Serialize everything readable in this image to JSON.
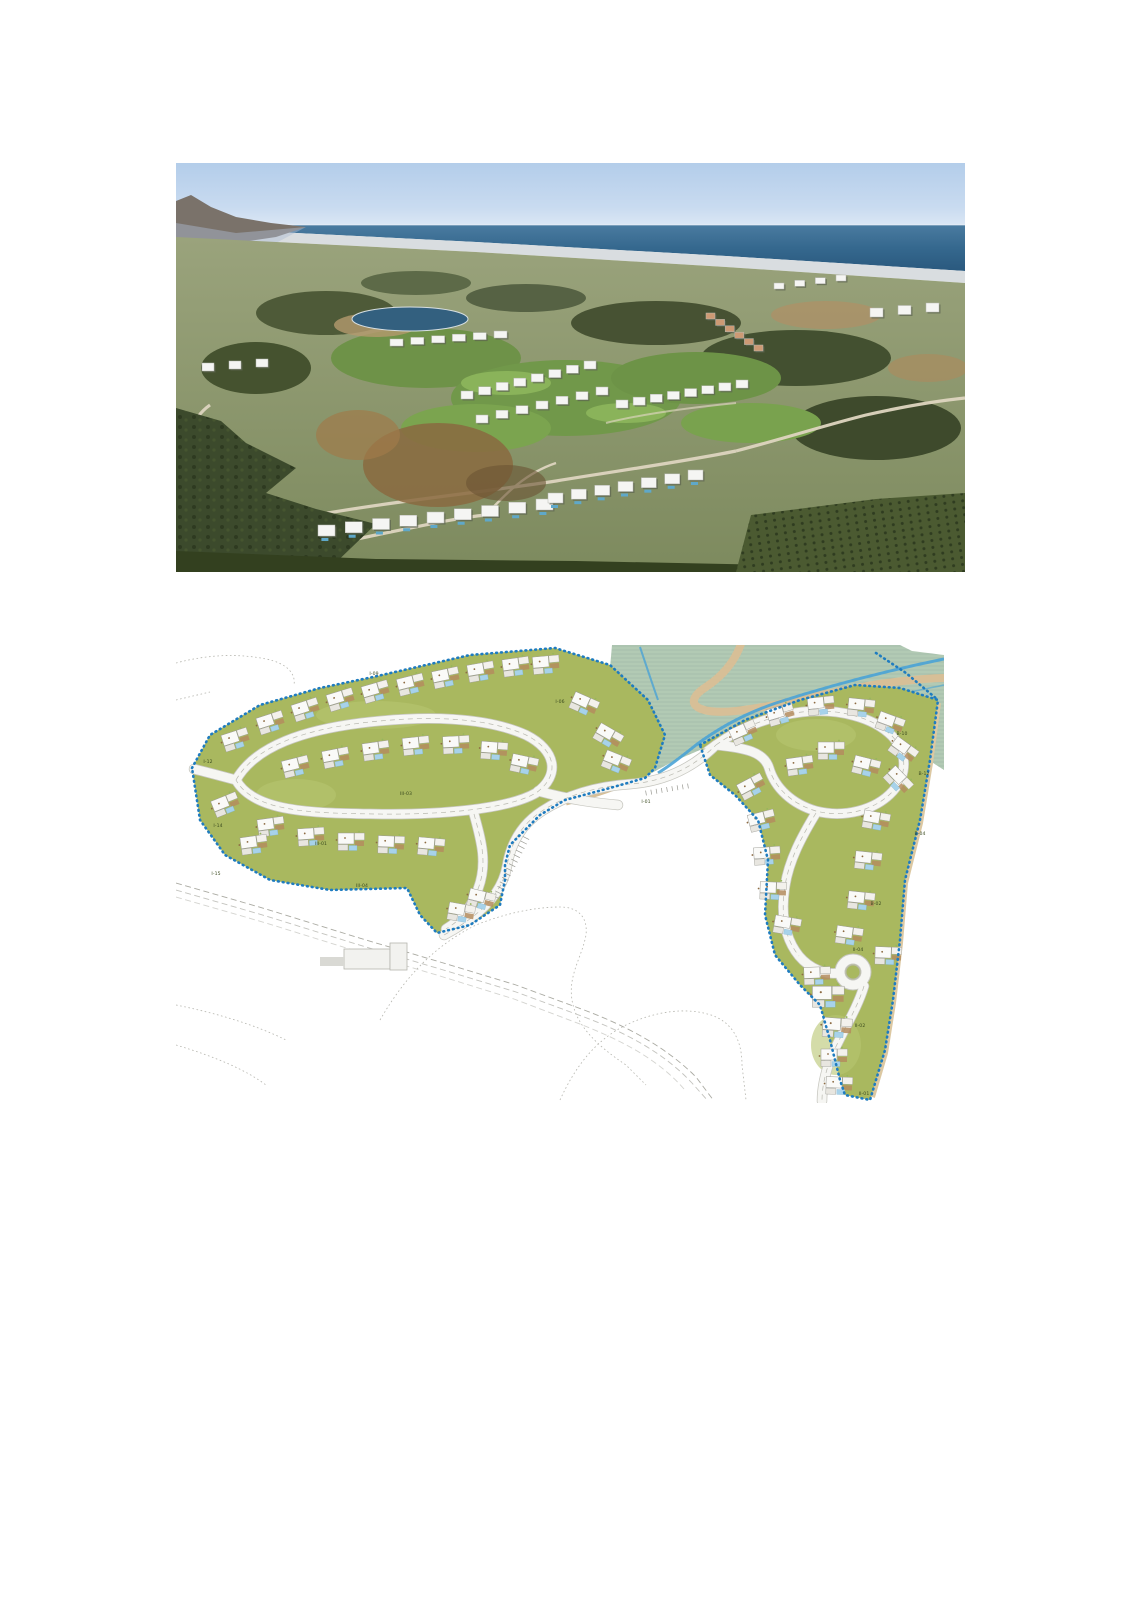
{
  "page": {
    "width": 1131,
    "height": 1600,
    "background": "#ffffff",
    "kind": "brochure-page-two-images"
  },
  "aerial_photo": {
    "name": "aerial-photo",
    "description": "Aerial photograph of a hillside resort: white modern villas along winding roads, golf course fairways with a small lake and hotel row, dark scrubland and orchards in the foreground, a coastal town strip and the Mediterranean sea on the horizon, mountain at left",
    "x": 176,
    "y": 163,
    "width": 789,
    "height": 409,
    "colors": {
      "sky": "#b5cfec",
      "sea": "#2e6089",
      "coast_city": "#d9dde0",
      "hills": "#97a076",
      "golf": "#7ba04f",
      "lake": "#33607f",
      "villas": "#f5f5f3",
      "foreground": "#35421f",
      "dirt": "#a9885c",
      "roads": "#ded5c0"
    }
  },
  "site_plan": {
    "name": "master-plan-map",
    "description": "Master plan drawing: two olive-green development areas bounded by a blue dotted line, internal loop roads with building footprints and pools, roundabout in the east sector, stream corridor with beige footpaths at top, faint dashed existing roads and contour lines around",
    "x": 176,
    "y": 645,
    "width": 768,
    "height": 458,
    "colors": {
      "plot_green": "#a9b85f",
      "road_fill": "#f6f6f3",
      "road_edge": "#c6c6bf",
      "boundary_dots": "#1f7cc0",
      "corridor": "#b8cdb6",
      "stream": "#4aa3d6",
      "path_beige": "#d7bf97",
      "building_white": "#fafaf8",
      "building_brown": "#b48c5e",
      "pool_blue": "#a7d2ea",
      "existing_lines": "#b0b0a9",
      "label_text": "#3a4a1f"
    },
    "plot_labels": [
      {
        "text": "I-09",
        "x": 198,
        "y": 30
      },
      {
        "text": "I-06",
        "x": 384,
        "y": 58
      },
      {
        "text": "I-01",
        "x": 470,
        "y": 158
      },
      {
        "text": "I-12",
        "x": 32,
        "y": 118
      },
      {
        "text": "I-14",
        "x": 42,
        "y": 182
      },
      {
        "text": "I-15",
        "x": 40,
        "y": 230
      },
      {
        "text": "III-03",
        "x": 230,
        "y": 150
      },
      {
        "text": "III-01",
        "x": 145,
        "y": 200
      },
      {
        "text": "III-04",
        "x": 186,
        "y": 242
      },
      {
        "text": "B-10",
        "x": 726,
        "y": 90
      },
      {
        "text": "B-12",
        "x": 748,
        "y": 130
      },
      {
        "text": "B-04",
        "x": 744,
        "y": 190
      },
      {
        "text": "B-02",
        "x": 700,
        "y": 260
      },
      {
        "text": "II-04",
        "x": 682,
        "y": 306
      },
      {
        "text": "II-02",
        "x": 684,
        "y": 382
      },
      {
        "text": "II-01",
        "x": 688,
        "y": 450
      }
    ],
    "building_clusters": [
      [
        60,
        95,
        -18
      ],
      [
        95,
        78,
        -18
      ],
      [
        130,
        65,
        -18
      ],
      [
        165,
        55,
        -17
      ],
      [
        200,
        47,
        -16
      ],
      [
        235,
        40,
        -14
      ],
      [
        270,
        33,
        -12
      ],
      [
        305,
        27,
        -10
      ],
      [
        340,
        22,
        -8
      ],
      [
        370,
        20,
        -5
      ],
      [
        120,
        122,
        -14
      ],
      [
        160,
        113,
        -11
      ],
      [
        200,
        106,
        -8
      ],
      [
        240,
        101,
        -6
      ],
      [
        280,
        100,
        -3
      ],
      [
        318,
        106,
        4
      ],
      [
        348,
        120,
        12
      ],
      [
        95,
        182,
        -8
      ],
      [
        135,
        192,
        -4
      ],
      [
        175,
        197,
        0
      ],
      [
        215,
        200,
        2
      ],
      [
        255,
        202,
        5
      ],
      [
        78,
        200,
        -8
      ],
      [
        50,
        160,
        -22
      ],
      [
        305,
        255,
        14
      ],
      [
        285,
        268,
        10
      ],
      [
        408,
        60,
        24
      ],
      [
        432,
        92,
        30
      ],
      [
        440,
        118,
        22
      ],
      [
        568,
        88,
        -24
      ],
      [
        605,
        70,
        -16
      ],
      [
        645,
        61,
        -6
      ],
      [
        685,
        63,
        6
      ],
      [
        714,
        79,
        20
      ],
      [
        727,
        106,
        36
      ],
      [
        722,
        136,
        46
      ],
      [
        655,
        106,
        0
      ],
      [
        624,
        121,
        -8
      ],
      [
        690,
        122,
        14
      ],
      [
        576,
        142,
        -28
      ],
      [
        586,
        176,
        -14
      ],
      [
        591,
        211,
        -4
      ],
      [
        597,
        246,
        2
      ],
      [
        611,
        281,
        10
      ],
      [
        700,
        176,
        10
      ],
      [
        692,
        216,
        6
      ],
      [
        685,
        256,
        6
      ],
      [
        673,
        291,
        8
      ],
      [
        712,
        311,
        2
      ],
      [
        641,
        331,
        -2
      ],
      [
        652,
        352,
        0,
        1.2
      ],
      [
        661,
        383,
        4,
        1.1
      ],
      [
        658,
        413,
        0
      ],
      [
        663,
        441,
        2
      ]
    ]
  }
}
